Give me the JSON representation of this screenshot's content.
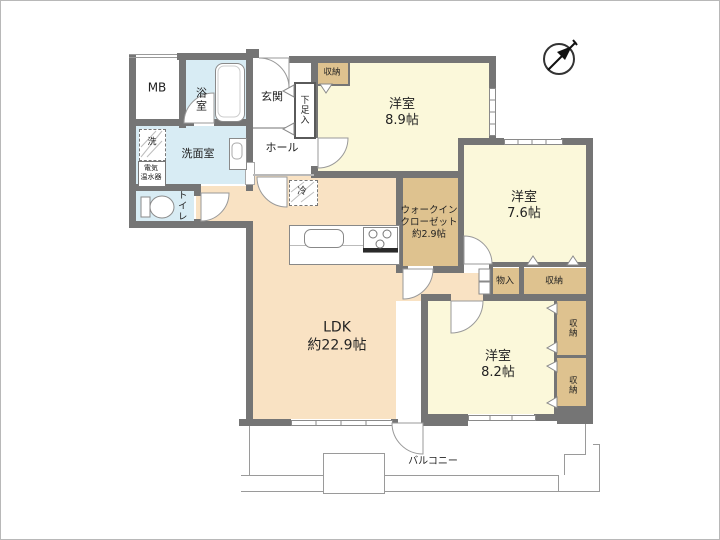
{
  "floorplan": {
    "rooms": {
      "mb": "MB",
      "bath": "浴室",
      "entrance": "玄関",
      "shoe_cabinet": "下足入",
      "closet_entrance": "収納",
      "hall": "ホール",
      "bedroom1": {
        "name": "洋室",
        "size": "8.9帖"
      },
      "washer": "洗",
      "washroom": "洗面室",
      "water_heater_line1": "電気",
      "water_heater_line2": "温水器",
      "toilet": "トイレ",
      "fridge": "冷",
      "wic_line1": "ウォークイン",
      "wic_line2": "クローゼット",
      "wic_line3": "約2.9帖",
      "bedroom2": {
        "name": "洋室",
        "size": "7.6帖"
      },
      "storage_mono": "物入",
      "closet_mid": "収納",
      "ldk": {
        "name": "LDK",
        "size": "約22.9帖"
      },
      "bedroom3": {
        "name": "洋室",
        "size": "8.2帖"
      },
      "closet_right_upper": "収納",
      "closet_right_lower": "収納",
      "balcony": "バルコニー"
    },
    "colors": {
      "wall": "#757575",
      "western_room": "#fbf8da",
      "ldk": "#f9e2c3",
      "closet": "#dec28f",
      "wet_area": "#d8ecf4"
    }
  }
}
